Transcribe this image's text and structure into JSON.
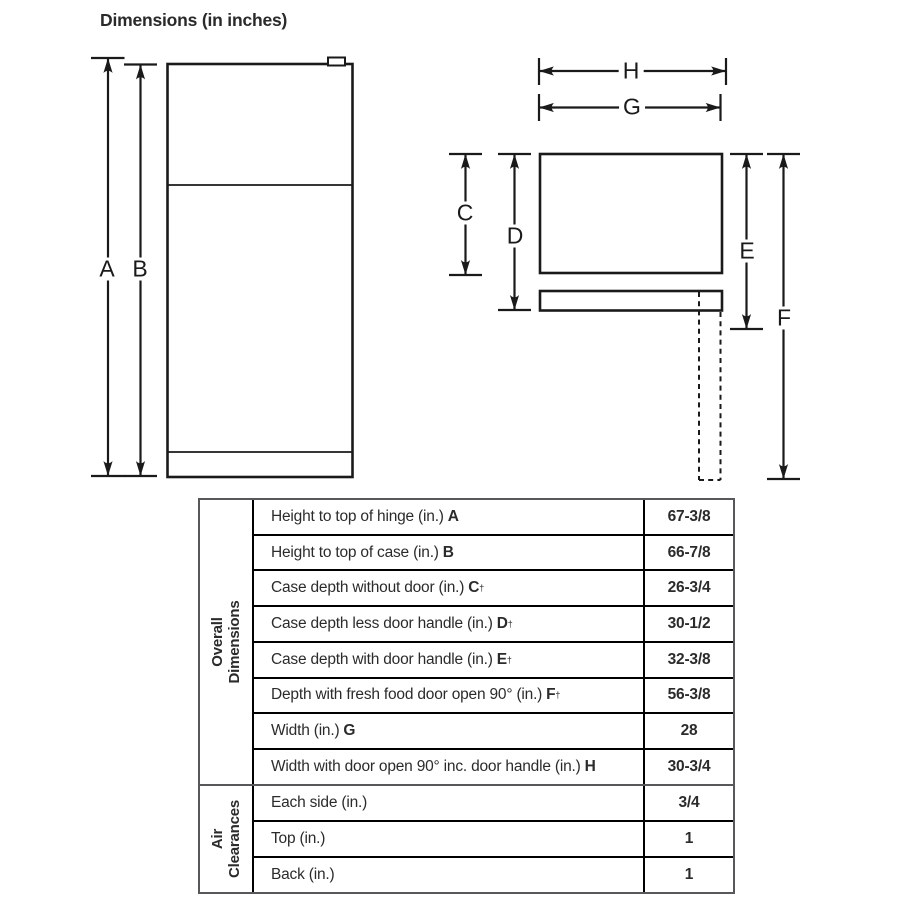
{
  "title": "Dimensions (in inches)",
  "diagram": {
    "labels": {
      "A": "A",
      "B": "B",
      "C": "C",
      "D": "D",
      "E": "E",
      "F": "F",
      "G": "G",
      "H": "H"
    }
  },
  "table": {
    "sections": [
      {
        "group_line1": "Overall",
        "group_line2": "Dimensions",
        "rows": [
          {
            "label": "Height to top of hinge (in.)",
            "letter": "A",
            "dagger": "",
            "value": "67-3/8"
          },
          {
            "label": "Height to top of case (in.)",
            "letter": "B",
            "dagger": "",
            "value": "66-7/8"
          },
          {
            "label": "Case depth without door (in.)",
            "letter": "C",
            "dagger": "†",
            "value": "26-3/4"
          },
          {
            "label": "Case depth less door handle (in.)",
            "letter": "D",
            "dagger": "†",
            "value": "30-1/2"
          },
          {
            "label": "Case depth with door handle (in.)",
            "letter": "E",
            "dagger": "†",
            "value": "32-3/8"
          },
          {
            "label": "Depth with fresh food door open 90° (in.)",
            "letter": "F",
            "dagger": "†",
            "value": "56-3/8"
          },
          {
            "label": "Width (in.)",
            "letter": "G",
            "dagger": "",
            "value": "28"
          },
          {
            "label": "Width with door open 90° inc. door handle (in.)",
            "letter": "H",
            "dagger": "",
            "value": "30-3/4"
          }
        ]
      },
      {
        "group_line1": "Air",
        "group_line2": "Clearances",
        "rows": [
          {
            "label": "Each side (in.)",
            "letter": "",
            "dagger": "",
            "value": "3/4"
          },
          {
            "label": "Top (in.)",
            "letter": "",
            "dagger": "",
            "value": "1"
          },
          {
            "label": "Back (in.)",
            "letter": "",
            "dagger": "",
            "value": "1"
          }
        ]
      }
    ]
  }
}
